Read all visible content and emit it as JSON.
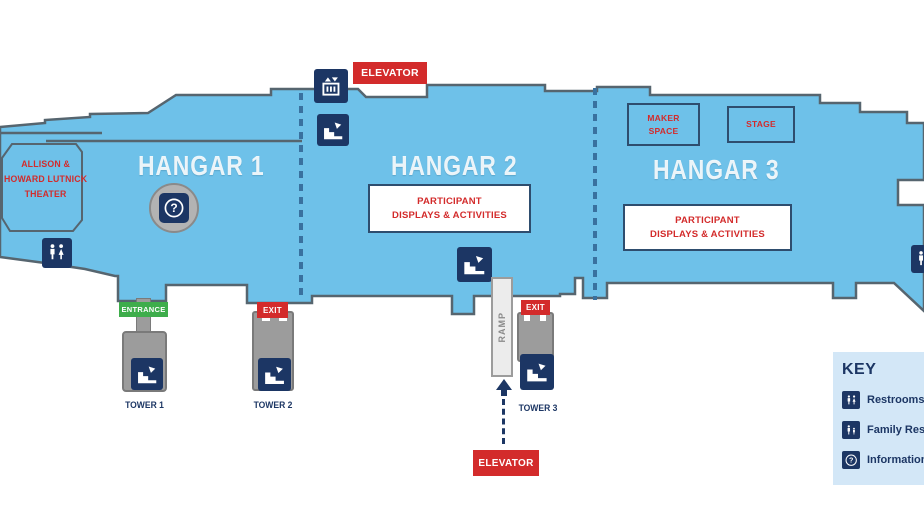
{
  "map": {
    "hangars": [
      {
        "label": "HANGAR 1"
      },
      {
        "label": "HANGAR 2"
      },
      {
        "label": "HANGAR 3"
      }
    ],
    "theater": {
      "label": "ALLISON &\nHOWARD LUTNICK\nTHEATER"
    },
    "areas": {
      "participant_h2": "PARTICIPANT\nDISPLAYS & ACTIVITIES",
      "participant_h3": "PARTICIPANT\nDISPLAYS & ACTIVITIES",
      "maker_space": "MAKER\nSPACE",
      "stage": "STAGE"
    },
    "badges": {
      "elevator_top": "ELEVATOR",
      "elevator_bottom": "ELEVATOR",
      "entrance": "ENTRANCE",
      "exit_tower2": "EXIT",
      "exit_tower3": "EXIT"
    },
    "towers": [
      {
        "label": "TOWER 1"
      },
      {
        "label": "TOWER 2"
      },
      {
        "label": "TOWER 3"
      }
    ],
    "ramp_label": "RAMP",
    "icons": {
      "elevator": "elevator-icon",
      "stairs": "stairs-icon",
      "restrooms": "restrooms-icon",
      "family_restroom": "family-restroom-icon",
      "information": "information-icon"
    }
  },
  "key": {
    "title": "KEY",
    "items": [
      {
        "icon": "restrooms",
        "label": "Restrooms"
      },
      {
        "icon": "family",
        "label": "Family Restrooms"
      },
      {
        "icon": "info",
        "label": "Information"
      }
    ]
  },
  "colors": {
    "deck_blue": "#6EC1E9",
    "outline": "#56656F",
    "navy": "#1C3664",
    "red": "#D32B2B",
    "green": "#3EAD4B",
    "gray": "#9C9C9C",
    "key_bg": "#D3E7F7",
    "dashed_divider_blue": "#39719F"
  }
}
